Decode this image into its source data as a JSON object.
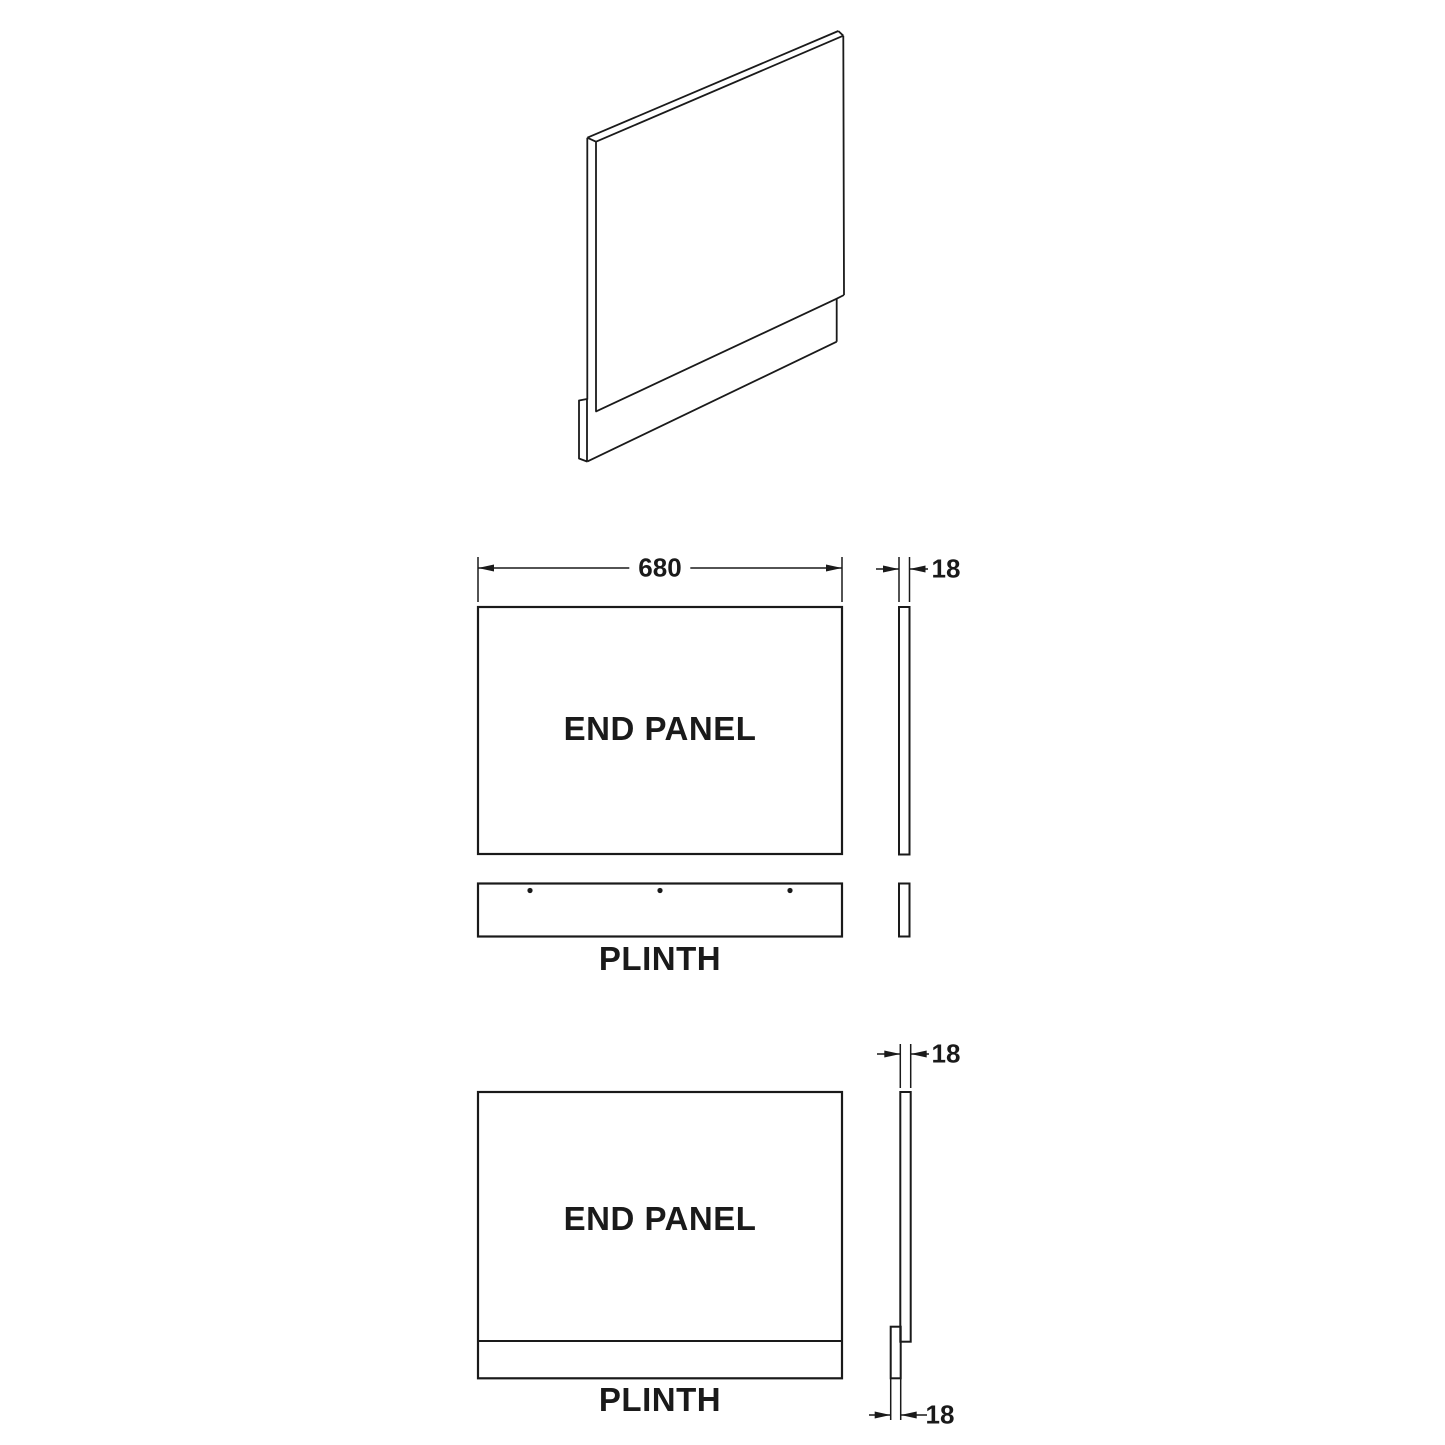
{
  "drawing": {
    "labels": {
      "end_panel": "END PANEL",
      "plinth": "PLINTH"
    },
    "dimensions": {
      "panel_width_mm": "680",
      "panel_thickness_mm": "18",
      "plinth_thickness_mm": "18"
    },
    "colors": {
      "line": "#1a1a1a",
      "background": "#ffffff"
    }
  }
}
